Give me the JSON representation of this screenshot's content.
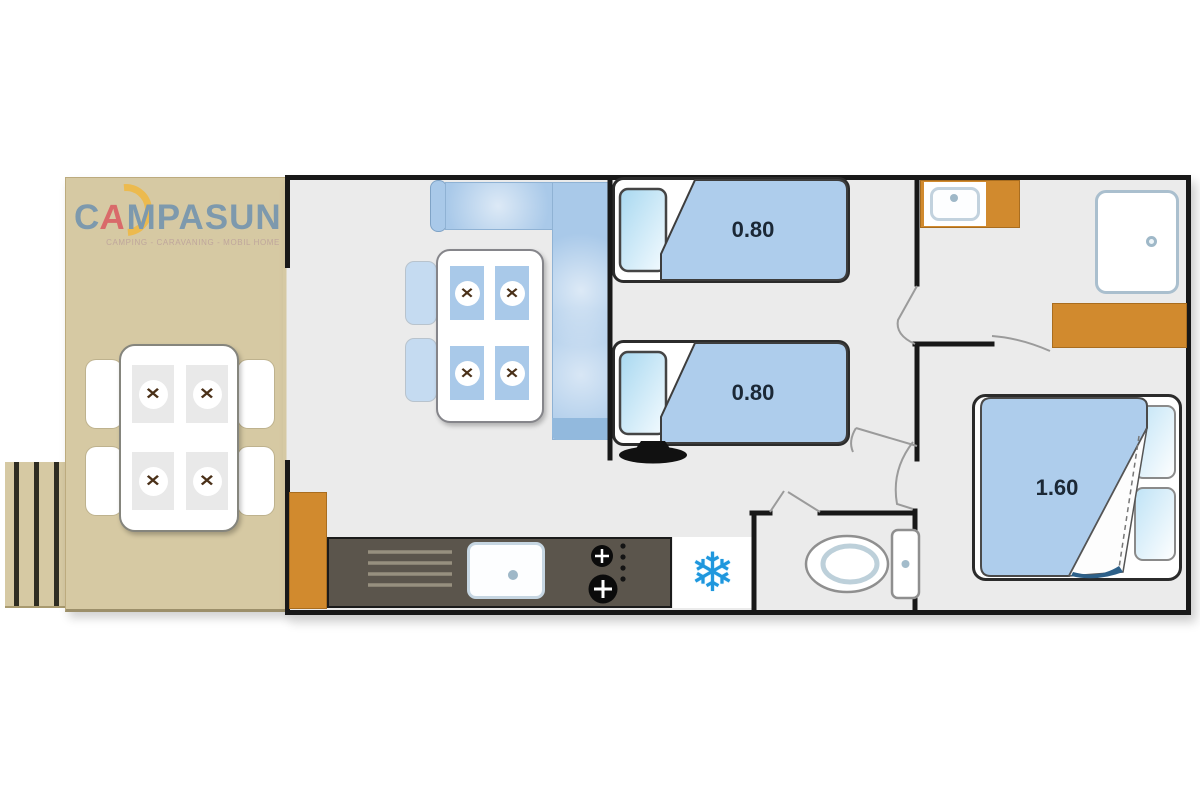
{
  "logo": {
    "brand": "CAMPASUN",
    "brand_c": "C",
    "brand_a": "A",
    "brand_rest": "MPASUN",
    "tagline": "CAMPING - CARAVANING - MOBIL HOME"
  },
  "beds": {
    "single_1": {
      "label": "0.80"
    },
    "single_2": {
      "label": "0.80"
    },
    "double": {
      "label": "1.60"
    }
  },
  "icons": {
    "snowflake_glyph": "❄",
    "cutlery_glyph": "✕"
  },
  "colors": {
    "terrace_beige": "#d6c9a3",
    "floor_gray": "#ebebeb",
    "wall_black": "#181818",
    "sofa_blue": "#a9c9e9",
    "duvet_blue": "#aecdec",
    "cabinet_orange": "#d18a2e",
    "counter_dark": "#5b554c",
    "snowflake_blue": "#1f97dd",
    "size_label_navy": "#1b2836",
    "logo_blue": "#7d99ad",
    "logo_red": "#d96a6a",
    "logo_yellow": "#ecba4e"
  }
}
